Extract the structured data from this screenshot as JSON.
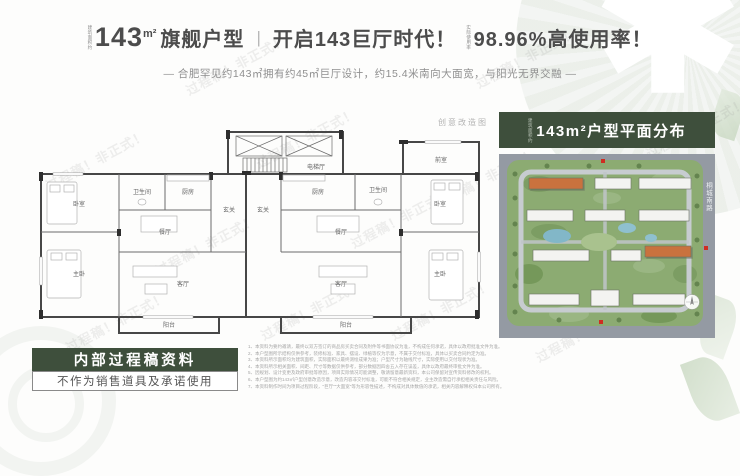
{
  "watermark": {
    "text": "过程稿！非正式！"
  },
  "header": {
    "area_prefix": "建筑面积约",
    "area_value": "143",
    "area_unit": "m²",
    "title_left": "旗舰户型",
    "divider": "|",
    "title_mid": "开启143巨厅时代！",
    "rate_prefix": "实际使用率",
    "title_right": "98.96%高使用率！",
    "subtitle": "— 合肥罕见约143㎡拥有约45㎡巨厅设计，约15.4米南向大面宽，与阳光无界交融 —"
  },
  "floorplan": {
    "caption": "创意改造图",
    "labels": [
      {
        "x": 46,
        "y": 94,
        "text": "卧室"
      },
      {
        "x": 109,
        "y": 82,
        "text": "卫生间"
      },
      {
        "x": 155,
        "y": 82,
        "text": "厨房"
      },
      {
        "x": 196,
        "y": 100,
        "text": "玄关"
      },
      {
        "x": 132,
        "y": 122,
        "text": "餐厅"
      },
      {
        "x": 150,
        "y": 174,
        "text": "客厅"
      },
      {
        "x": 46,
        "y": 164,
        "text": "主卧"
      },
      {
        "x": 136,
        "y": 215,
        "text": "阳台"
      },
      {
        "x": 230,
        "y": 100,
        "text": "玄关"
      },
      {
        "x": 285,
        "y": 82,
        "text": "厨房"
      },
      {
        "x": 345,
        "y": 80,
        "text": "卫生间"
      },
      {
        "x": 407,
        "y": 94,
        "text": "卧室"
      },
      {
        "x": 308,
        "y": 122,
        "text": "餐厅"
      },
      {
        "x": 308,
        "y": 174,
        "text": "客厅"
      },
      {
        "x": 407,
        "y": 164,
        "text": "主卧"
      },
      {
        "x": 313,
        "y": 215,
        "text": "阳台"
      },
      {
        "x": 283,
        "y": 57,
        "text": "电梯厅"
      },
      {
        "x": 408,
        "y": 50,
        "text": "前室"
      }
    ]
  },
  "siteplan": {
    "title_prefix": "建筑面积约",
    "title": "143m²户型平面分布",
    "road_label": "桐城南路"
  },
  "stamp": {
    "line1": "内部过程稿资料",
    "line2": "不作为销售道具及承诺使用"
  },
  "disclaimers": [
    "1、本资料为要约邀请，最终以双方签订的商品房买卖合同及附件等书面协议为准，不构成任何承诺，具体以政府批准文件为准。",
    "2、本户型图所示结构仅供参考，装修标准、家具、摆设、绿植等仅为示意，不属于交付标准，具体以买卖合同约定为准。",
    "3、本资料所示面积均为建筑面积，实际面积以最终测绘成果为准；户型尺寸为轴线尺寸，实际使用以交付现状为准。",
    "4、本资料所示相关面积、间距、尺寸等数据仅供参考，部分数据因四舍五入存在误差，具体以政府最终审批文件为准。",
    "5、因规划、设计变更及政府审批等原因，项目实际情况可能调整，敬请留意最新资料，本公司保留对宣传资料修改的权利。",
    "6、本户型图为约143㎡户型创意改造示意，改造内容非交付标准，可能不符合相关规定，业主改造需自行承担相关责任与风险。",
    "7、本资料制作时间为项目过程阶段，\"巨厅\"\"大面宽\"等为形容性描述，不构成对具体数值的承诺，相关内容解释权归本公司所有。"
  ]
}
